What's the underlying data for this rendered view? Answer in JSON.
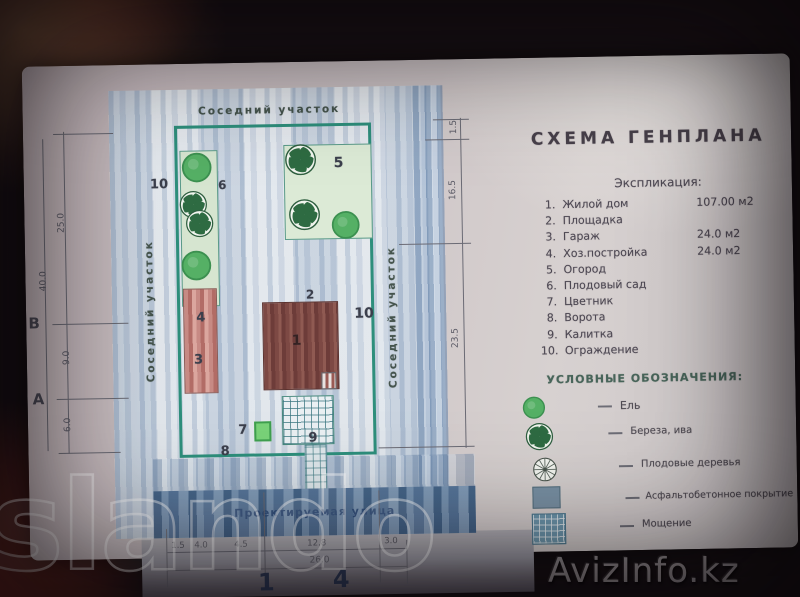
{
  "watermarks": {
    "site": "slando",
    "portal": "AvizInfo.kz"
  },
  "plan": {
    "neighbor_top": "Соседний участок",
    "neighbor_left": "Соседний участок",
    "neighbor_right": "Соседний участок",
    "street_label": "Проектируемая улица",
    "labels": {
      "fence_left": "10",
      "orchard": "6",
      "garden": "5",
      "outbuilding": "4",
      "garage": "3",
      "house": "1",
      "platform": "2",
      "fence_right": "10",
      "flowerbed": "7",
      "gate": "8",
      "wicket": "9"
    },
    "dimensions": {
      "right": [
        "1.5",
        "16.5",
        "23.5"
      ],
      "left_total": "40.0",
      "left_segments": [
        "25.0",
        "9.0",
        "6.0"
      ],
      "left_axes": [
        "В",
        "А"
      ],
      "bottom_segments": [
        "1.5",
        "4.0",
        "4.5",
        "12.8",
        "3.0"
      ],
      "bottom_total": "26.0",
      "bottom_axes": [
        "1",
        "4"
      ]
    }
  },
  "info": {
    "title": "СХЕМА ГЕНПЛАНА",
    "explication": {
      "heading": "Экспликация:",
      "items": [
        {
          "num": "1.",
          "name": "Жилой дом",
          "area": "107.00 м2"
        },
        {
          "num": "2.",
          "name": "Площадка",
          "area": ""
        },
        {
          "num": "3.",
          "name": "Гараж",
          "area": "24.0 м2"
        },
        {
          "num": "4.",
          "name": "Хоз.постройка",
          "area": "24.0 м2"
        },
        {
          "num": "5.",
          "name": "Огород",
          "area": ""
        },
        {
          "num": "6.",
          "name": "Плодовый сад",
          "area": ""
        },
        {
          "num": "7.",
          "name": "Цветник",
          "area": ""
        },
        {
          "num": "8.",
          "name": "Ворота",
          "area": ""
        },
        {
          "num": "9.",
          "name": "Калитка",
          "area": ""
        },
        {
          "num": "10.",
          "name": "Ограждение",
          "area": ""
        }
      ]
    },
    "legend": {
      "heading": "УСЛОВНЫЕ ОБОЗНАЧЕНИЯ:",
      "items": [
        {
          "icon": "spruce",
          "label": "Ель"
        },
        {
          "icon": "birch-willow",
          "label": "Береза, ива"
        },
        {
          "icon": "fruit-tree",
          "label": "Плодовые деревья"
        },
        {
          "icon": "asphalt",
          "label": "Асфальтобетонное покрытие"
        },
        {
          "icon": "paving",
          "label": "Мощение"
        }
      ]
    }
  },
  "colors": {
    "boundary": "#2e8f7c",
    "house": "#7a4540",
    "garage": "#bd7a74",
    "tree_green": "#55b065",
    "street_blue": "#6585a8",
    "legend_heading": "#48655a"
  }
}
